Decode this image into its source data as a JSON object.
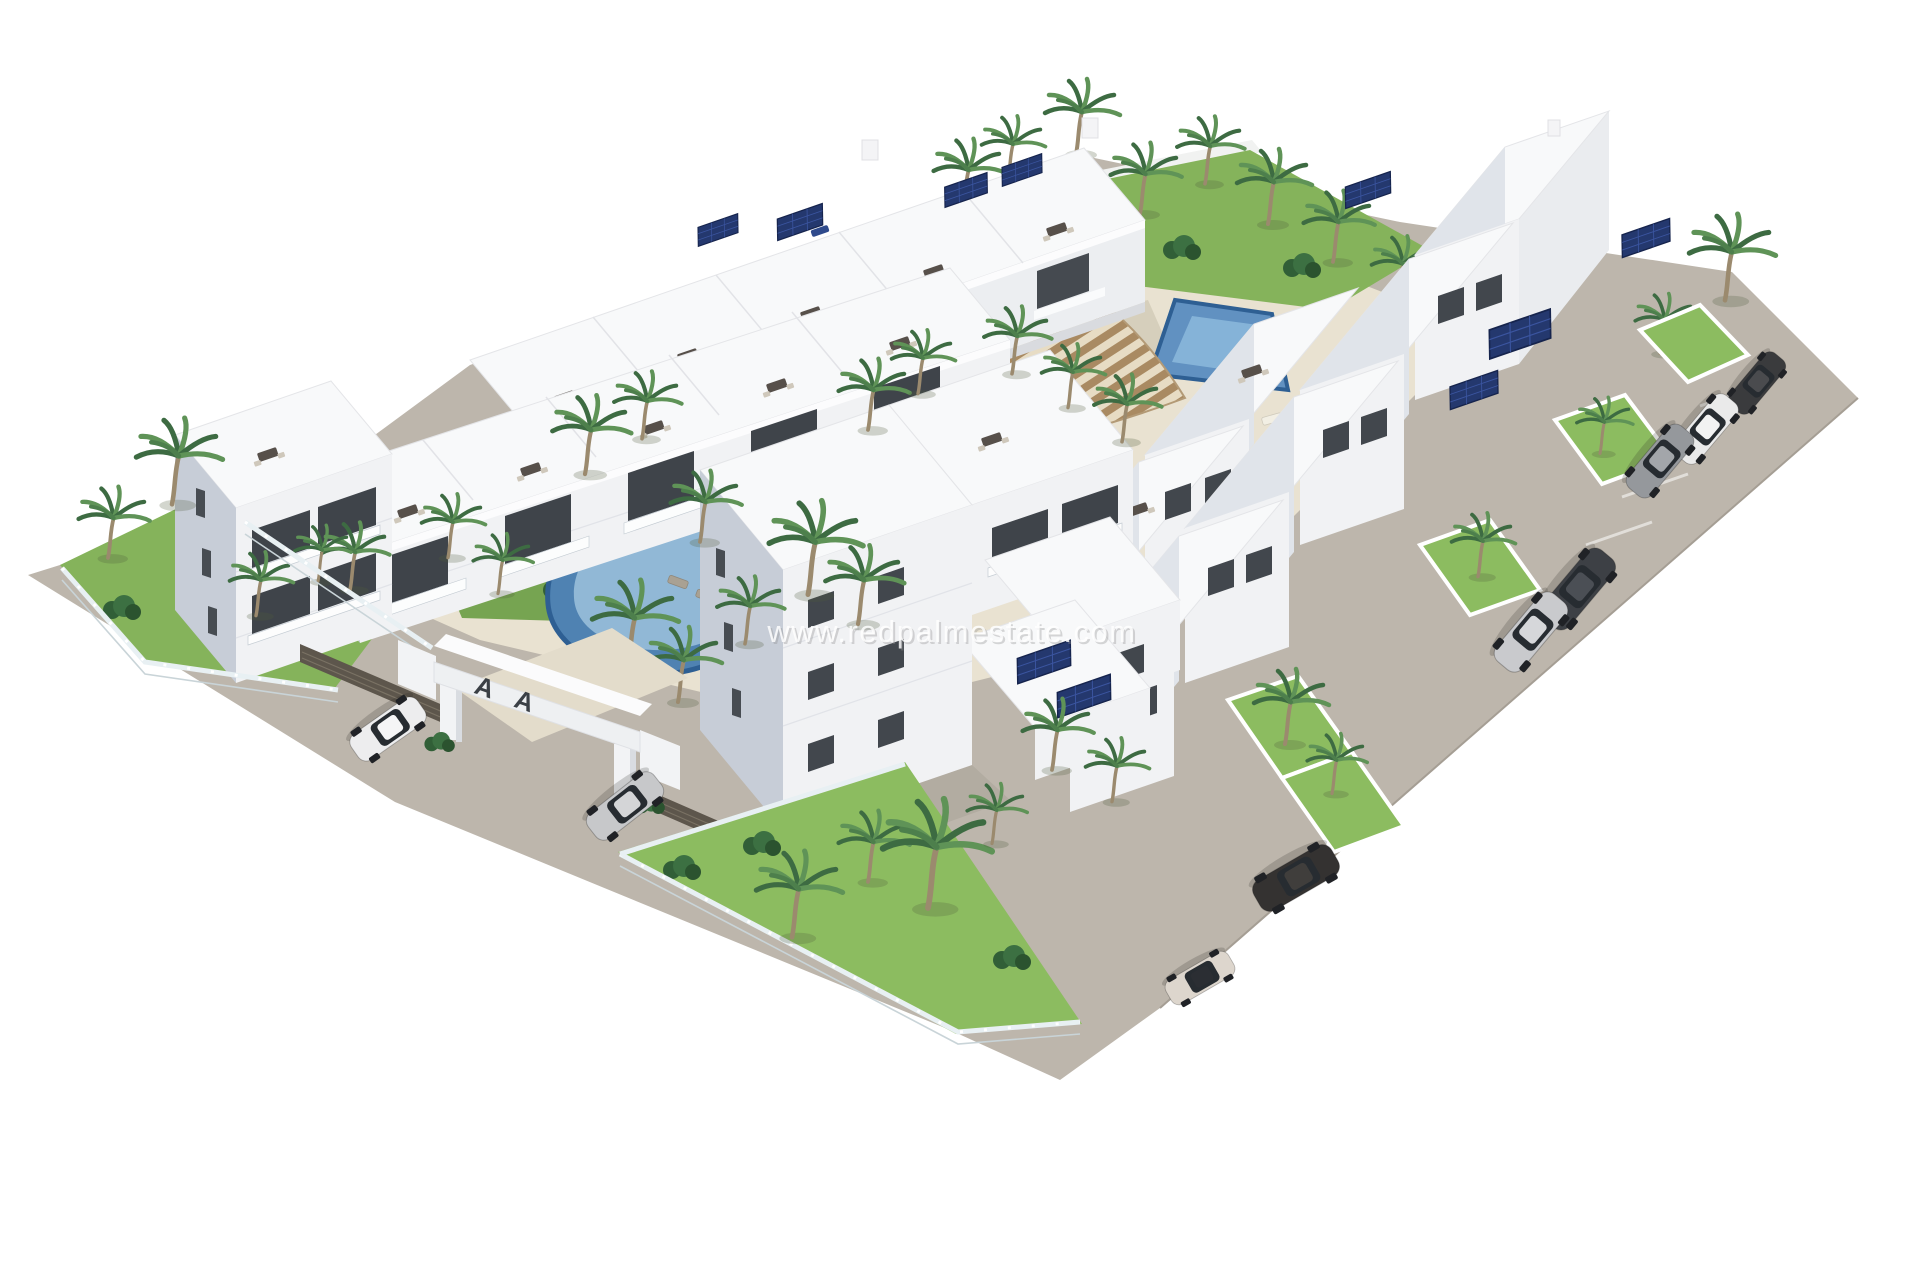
{
  "watermark": {
    "text": "www.redpalmestate.com",
    "color": "#ffffff"
  },
  "entrance": {
    "logo_text": "A A"
  },
  "palette": {
    "background": "#ffffff",
    "pavement": "#bdb6ac",
    "pavement_edge": "#a59e94",
    "deck": "#e9e2d1",
    "walkway": "#e3dccb",
    "building_white": "#f8f9fa",
    "building_face": "#f1f2f4",
    "building_shaded": "#c7cdd7",
    "window_glass": "#3f444a",
    "railing_glass": "#dfe7ec",
    "grass": "#85b35b",
    "grass_bright": "#8cbc60",
    "shrub": "#315f37",
    "palm_dark": "#3d6b42",
    "palm_light": "#5f9357",
    "palm_trunk": "#9b8a6e",
    "pool_rim": "#2e5f93",
    "pergola_wood": "#a98a62",
    "solar_panel": "#24386e",
    "fence_dark": "#5d564c"
  },
  "scene": {
    "pools": [
      {
        "name": "kidney-pool",
        "water": "#4f82b2",
        "water_light": "#9cc2dc"
      },
      {
        "name": "lap-pool",
        "water": "#6191c1",
        "water_light": "#8ab7da"
      }
    ],
    "cars": [
      {
        "name": "compact-dark",
        "color": "#3a3b3d",
        "roof": "#4a4b4e"
      },
      {
        "name": "hatch-white",
        "color": "#eaeaea",
        "roof": "#f2f2f2"
      },
      {
        "name": "suv-gray",
        "color": "#95989c",
        "roof": "#a3a6aa"
      },
      {
        "name": "sedan-dark",
        "color": "#3d4045",
        "roof": "#4b4f55"
      },
      {
        "name": "sedan-silver",
        "color": "#c9cacd",
        "roof": "#d6d7da"
      },
      {
        "name": "wagon-dark",
        "color": "#343231",
        "roof": "#403e3c"
      },
      {
        "name": "citycar-beige",
        "color": "#ddd6cd",
        "roof": "#2b2e33"
      },
      {
        "name": "suv-white",
        "color": "#ededee",
        "roof": "#f5f5f6"
      },
      {
        "name": "sedan-silver-2",
        "color": "#c7c8ca",
        "roof": "#d4d5d7"
      }
    ],
    "palm_count": 40,
    "solar_array_count": 10,
    "buildings": [
      "left-back-row",
      "left-front-row",
      "left-corner-building",
      "inner-right-row",
      "road-row",
      "center-block",
      "solar-wing",
      "tall-corner-building",
      "entrance-gate"
    ]
  }
}
